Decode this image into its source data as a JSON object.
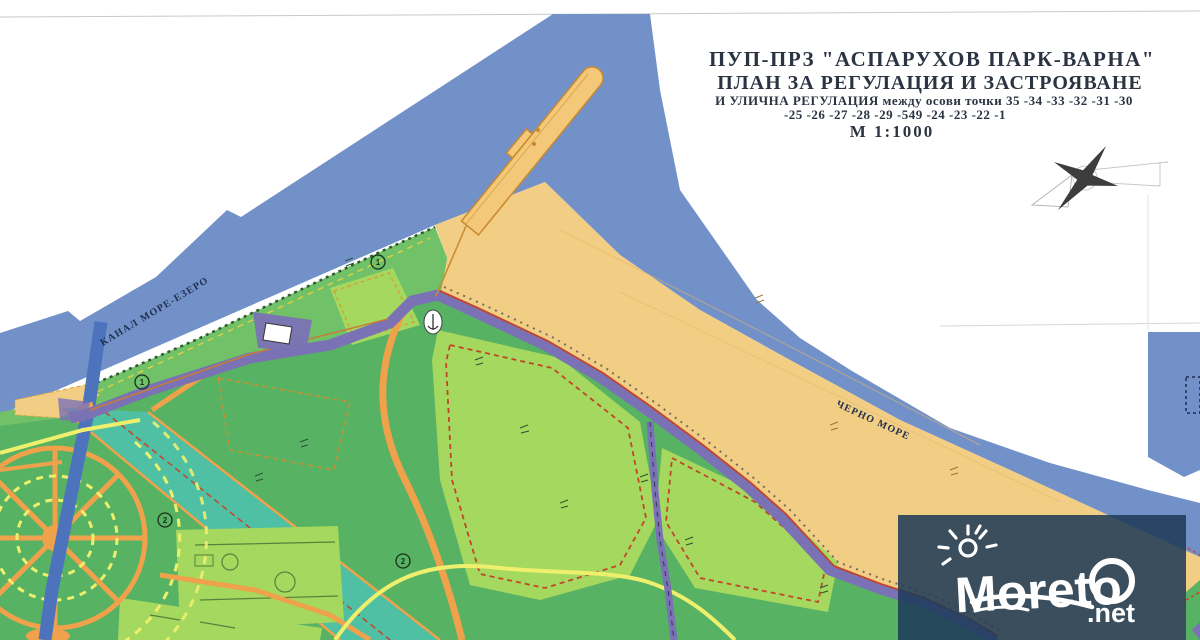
{
  "title_block": {
    "line1": "ПУП-ПРЗ \"АСПАРУХОВ ПАРК-ВАРНА\"",
    "line2": "ПЛАН ЗА РЕГУЛАЦИЯ И ЗАСТРОЯВАНЕ",
    "line3": "И УЛИЧНА РЕГУЛАЦИЯ между осови точки 35 -34 -33 -32 -31 -30",
    "line4": "-25 -26 -27 -28 -29 -549 -24 -23 -22 -1",
    "line5": "М 1:1000"
  },
  "map_labels": {
    "canal_label": "КАНАЛ МОРЕ-ЕЗЕРО",
    "sea_label": "ЧЕРНО МОРЕ"
  },
  "plan_markers": [
    {
      "label": "1",
      "x": 142,
      "y": 382
    },
    {
      "label": "1",
      "x": 378,
      "y": 262
    },
    {
      "label": "2",
      "x": 165,
      "y": 520
    },
    {
      "label": "2",
      "x": 403,
      "y": 561
    }
  ],
  "watermark": {
    "brand": "Moreto",
    "tld": ".net"
  },
  "colors": {
    "paper": "#ffffff",
    "sea": "#7291c9",
    "beach": "#f2cd84",
    "pier": "#f3c878",
    "pier_edge": "#c9892f",
    "park": "#58b264",
    "shore_strip": "#70c167",
    "plot_light": "#a5d85f",
    "teal": "#4fc0a4",
    "road_purple": "#7a72b5",
    "road_orange": "#efa14b",
    "path_yellow": "#eef06d",
    "red_dash": "#c2452a",
    "blue_road": "#4d73bc",
    "overlay": "rgba(30,59,88,0.87)",
    "ink_title": "#2b3442",
    "ink_label": "#20304f",
    "compass": "#3d3d3d"
  }
}
